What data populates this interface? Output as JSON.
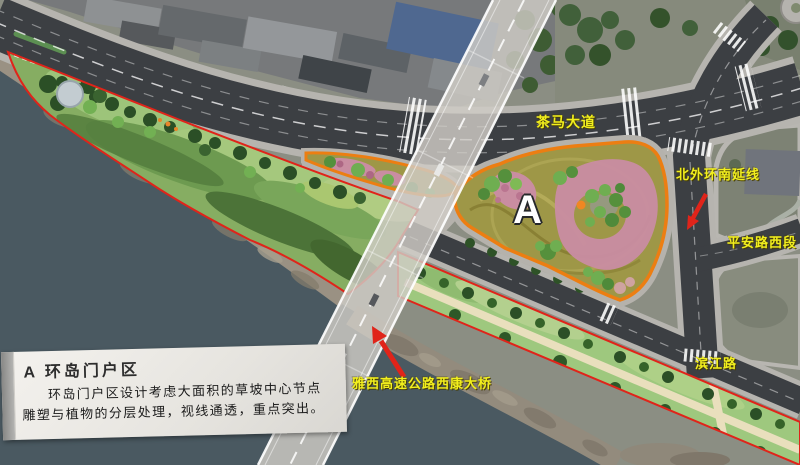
{
  "colors": {
    "label-yellow": "#f2ef1d",
    "annotation-red": "#e0241a",
    "area-border-orange": "#ec7e12",
    "water": "#4a5961"
  },
  "plan": {
    "area_letter": "A"
  },
  "labels": {
    "chama_avenue": "茶马大道",
    "beiwaihuan_extension": "北外环南延线",
    "pingan_road_west": "平安路西段",
    "binjiang_road": "滨江路",
    "yaxi_expressway_bridge": "雅西高速公路西康大桥"
  },
  "info_box": {
    "title": "A 环岛门户区",
    "body": "环岛门户区设计考虑大面积的草坡中心节点雕塑与植物的分层处理，视线通透，重点突出。"
  }
}
